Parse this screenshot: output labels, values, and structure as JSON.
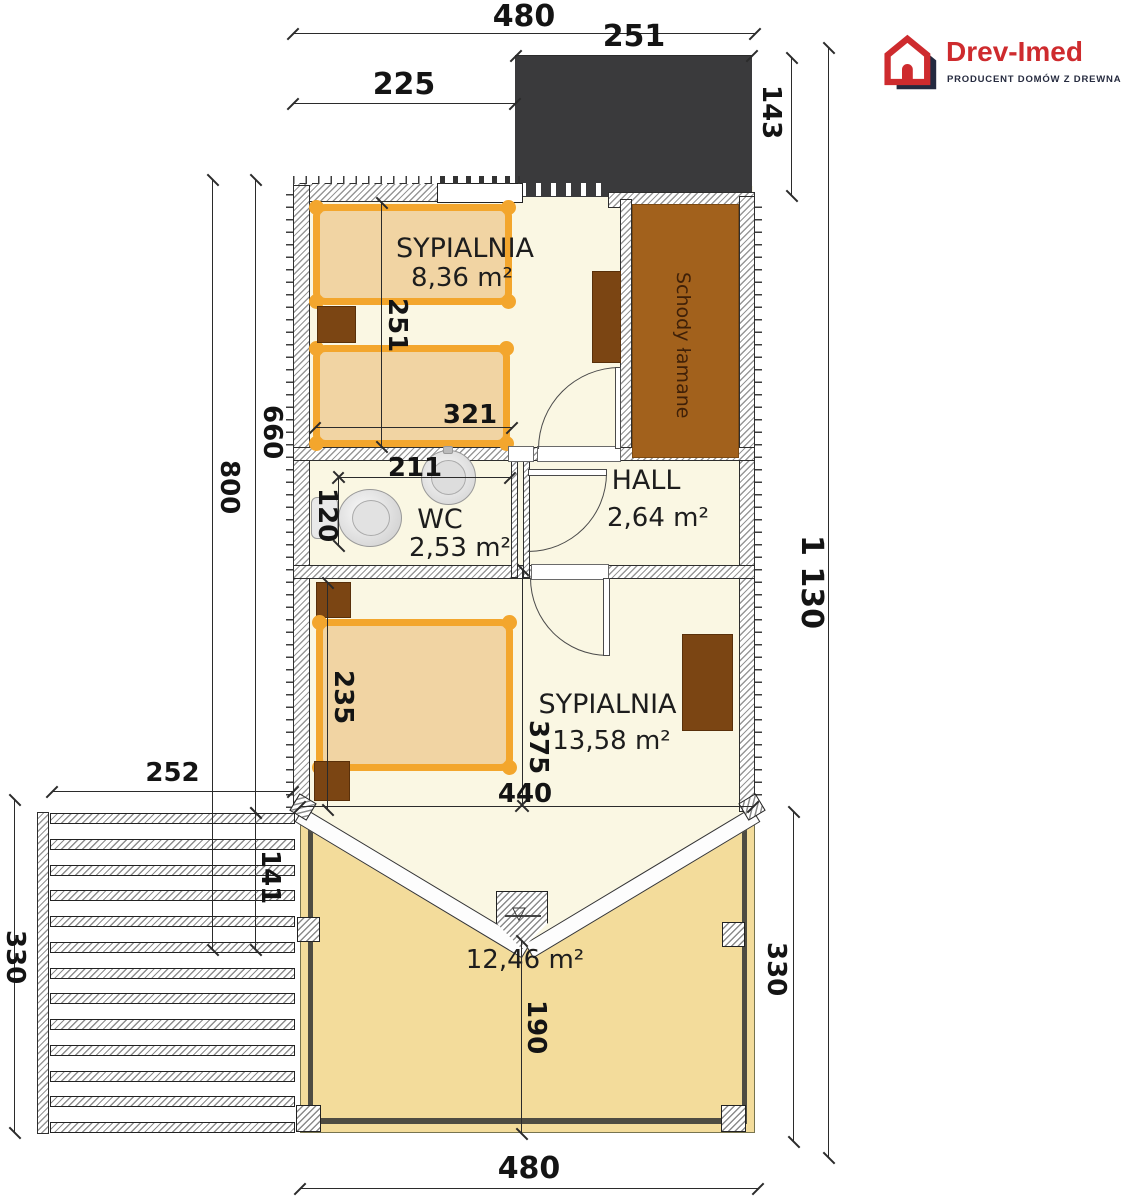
{
  "logo": {
    "title": "Drev-Imed",
    "subtitle": "PRODUCENT DOMÓW Z DREWNA"
  },
  "rooms": {
    "bedroom1": {
      "name": "SYPIALNIA",
      "area": "8,36 m²"
    },
    "wc": {
      "name": "WC",
      "area": "2,53 m²"
    },
    "hall": {
      "name": "HALL",
      "area": "2,64 m²"
    },
    "bedroom2": {
      "name": "SYPIALNIA",
      "area": "13,58 m²"
    },
    "balcony": {
      "area": "12,46 m²"
    },
    "stairs": {
      "label": "Schody łamane"
    }
  },
  "dimensions": {
    "top_width": "480",
    "roof_width": "251",
    "top_left_offset": "225",
    "roof_depth": "143",
    "total_height": "1 130",
    "left_outer": "800",
    "left_inner": "660",
    "bed1_spacing": "251",
    "bed1_length": "321",
    "wc_width": "211",
    "wc_depth": "120",
    "bed2_width": "235",
    "bedroom2_depth": "375",
    "bedroom2_width": "440",
    "deck_width": "252",
    "deck_inner": "141",
    "deck_height": "330",
    "balcony_center": "190",
    "balcony_height": "330",
    "bottom_width": "480"
  },
  "icons": {
    "level_marker": "▽"
  },
  "colors": {
    "floor": "#faf7e3",
    "balcony_floor": "#f3dc9b",
    "bed_frame": "#f3a62d",
    "bed_fill": "#f1d4a3",
    "furniture": "#7b4513",
    "stairs": "#a2611c",
    "roof": "#3a3a3c",
    "logo_red": "#ce2b2e",
    "logo_navy": "#242a40"
  }
}
